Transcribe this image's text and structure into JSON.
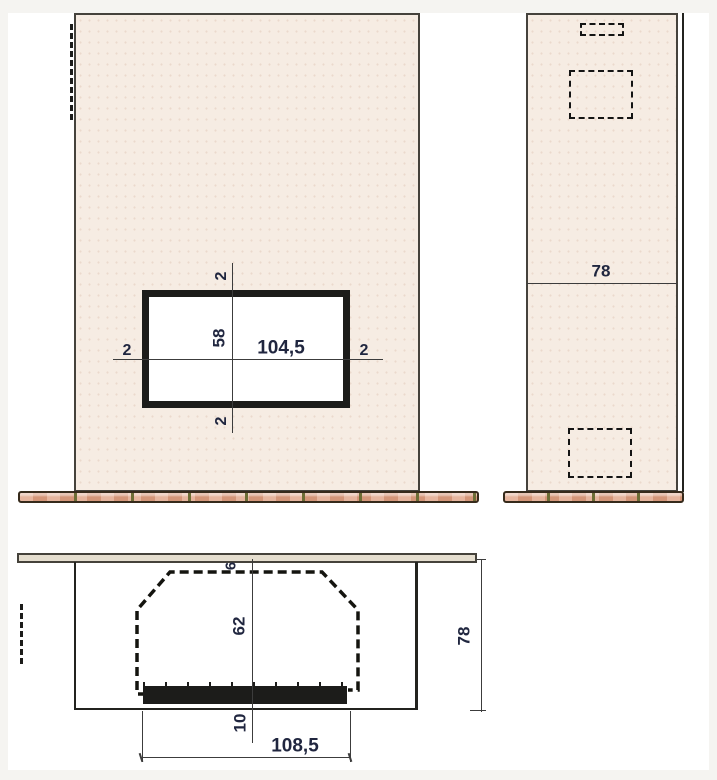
{
  "drawing_title": "fireplace-three-view-dimension-drawing",
  "colors": {
    "panel-fill": "#f6ece3",
    "plate-fill": "#e5decf",
    "tile-fill": "#dfa083",
    "line-dark": "#2b2b27",
    "dim-text": "#20263f",
    "frame-fill": "#1c1c1a",
    "paper": "#ffffff",
    "margin": "#f5f4f1"
  },
  "front_view": {
    "dims": {
      "opening_width": "104,5",
      "opening_height": "58",
      "top_offset": "2",
      "bottom_offset": "2",
      "left_offset": "2",
      "right_offset": "2"
    }
  },
  "side_view": {
    "dims": {
      "depth": "78"
    }
  },
  "plan_view": {
    "dims": {
      "rear_gap": "6",
      "chamber_depth": "62",
      "front_depth": "10",
      "chamber_width": "108,5",
      "overall_depth": "78"
    }
  }
}
